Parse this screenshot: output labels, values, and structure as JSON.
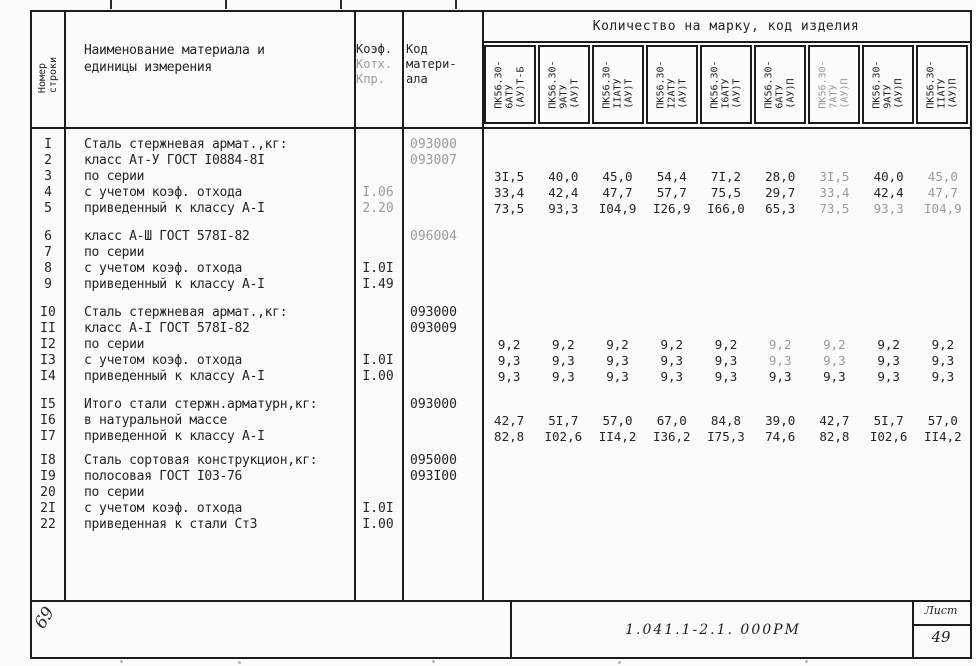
{
  "header": {
    "num_col_l1": "Номер",
    "num_col_l2": "строки",
    "material_l1": "Наименование материала и",
    "material_l2": "единицы измерения",
    "coef_l1": "Коэф.",
    "coef_l2": "Котх.",
    "coef_l3": "Кпр.",
    "code_l1": "Код",
    "code_l2": "матери-",
    "code_l3": "ала",
    "quantity_title": "Количество на марку, код изделия",
    "marks": [
      {
        "lines": [
          "ПК56.30-",
          "6АТУ",
          "(АУ)Т-Б"
        ],
        "faint": false
      },
      {
        "lines": [
          "ПК56.30-",
          "9АТУ",
          "(АУ)Т"
        ],
        "faint": false
      },
      {
        "lines": [
          "ПК56.30-",
          "IIАТУ",
          "(АУ)Т"
        ],
        "faint": false
      },
      {
        "lines": [
          "ПК56.30-",
          "I2АТУ",
          "(АУ)Т"
        ],
        "faint": false
      },
      {
        "lines": [
          "ПК56.30-",
          "I6АТУ",
          "(АУ)Т"
        ],
        "faint": false
      },
      {
        "lines": [
          "ПК56.30-",
          "6АТУ",
          "(АУ)П"
        ],
        "faint": false
      },
      {
        "lines": [
          "ПК56.30-",
          "7АТУ",
          "(АУ)П"
        ],
        "faint": true
      },
      {
        "lines": [
          "ПК56.30-",
          "9АТУ",
          "(АУ)П"
        ],
        "faint": false
      },
      {
        "lines": [
          "ПК56.30-",
          "IIАТУ",
          "(АУ)П"
        ],
        "faint": false
      }
    ]
  },
  "body": {
    "blocks": [
      {
        "rows": [
          {
            "num": "I",
            "name": "Сталь стержневая армат.,кг:",
            "coef": "",
            "code": "093000",
            "code_faint": true,
            "values": null,
            "faint_cols": []
          },
          {
            "num": "2",
            "name": "класс Ат-У ГОСТ I0884-8I",
            "coef": "",
            "code": "093007",
            "code_faint": true,
            "values": null,
            "faint_cols": []
          },
          {
            "num": "3",
            "name": "по серии",
            "coef": "",
            "code": "",
            "values": [
              "3I,5",
              "40,0",
              "45,0",
              "54,4",
              "7I,2",
              "28,0",
              "3I,5",
              "40,0",
              "45,0"
            ],
            "faint_cols": [
              6,
              8
            ]
          },
          {
            "num": "4",
            "name": "с учетом коэф. отхода",
            "coef": "I.06",
            "coef_faint": true,
            "code": "",
            "values": [
              "33,4",
              "42,4",
              "47,7",
              "57,7",
              "75,5",
              "29,7",
              "33,4",
              "42,4",
              "47,7"
            ],
            "faint_cols": [
              6,
              8
            ]
          },
          {
            "num": "5",
            "name": "приведенный к классу А-I",
            "coef": "2.20",
            "coef_faint": true,
            "code": "",
            "values": [
              "73,5",
              "93,3",
              "I04,9",
              "I26,9",
              "I66,0",
              "65,3",
              "73,5",
              "93,3",
              "I04,9"
            ],
            "faint_cols": [
              6,
              7,
              8
            ]
          }
        ]
      },
      {
        "rows": [
          {
            "num": "6",
            "name": "класс А-Ш ГОСТ 578I-82",
            "coef": "",
            "code": "096004",
            "code_faint": true,
            "values": null,
            "faint_cols": []
          },
          {
            "num": "7",
            "name": "по серии",
            "coef": "",
            "code": "",
            "values": null,
            "faint_cols": []
          },
          {
            "num": "8",
            "name": "с учетом коэф. отхода",
            "coef": "I.0I",
            "code": "",
            "values": null,
            "faint_cols": []
          },
          {
            "num": "9",
            "name": "приведенный к классу А-I",
            "coef": "I.49",
            "code": "",
            "values": null,
            "faint_cols": []
          }
        ]
      },
      {
        "rows": [
          {
            "num": "I0",
            "name": "Сталь стержневая армат.,кг:",
            "coef": "",
            "code": "093000",
            "values": null,
            "faint_cols": []
          },
          {
            "num": "II",
            "name": "класс А-I ГОСТ 578I-82",
            "coef": "",
            "code": "093009",
            "values": null,
            "faint_cols": []
          },
          {
            "num": "I2",
            "name": "по серии",
            "coef": "",
            "code": "",
            "values": [
              "9,2",
              "9,2",
              "9,2",
              "9,2",
              "9,2",
              "9,2",
              "9,2",
              "9,2",
              "9,2"
            ],
            "faint_cols": [
              5,
              6
            ]
          },
          {
            "num": "I3",
            "name": "с учетом коэф. отхода",
            "coef": "I.0I",
            "code": "",
            "values": [
              "9,3",
              "9,3",
              "9,3",
              "9,3",
              "9,3",
              "9,3",
              "9,3",
              "9,3",
              "9,3"
            ],
            "faint_cols": [
              5,
              6
            ]
          },
          {
            "num": "I4",
            "name": "приведенный к классу А-I",
            "coef": "I.00",
            "code": "",
            "values": [
              "9,3",
              "9,3",
              "9,3",
              "9,3",
              "9,3",
              "9,3",
              "9,3",
              "9,3",
              "9,3"
            ],
            "faint_cols": []
          }
        ]
      },
      {
        "rows": [
          {
            "num": "I5",
            "name": "Итого стали стержн.арматурн,кг:",
            "coef": "",
            "code": "093000",
            "values": null,
            "faint_cols": []
          },
          {
            "num": "I6",
            "name": "в натуральной массе",
            "coef": "",
            "code": "",
            "values": [
              "42,7",
              "5I,7",
              "57,0",
              "67,0",
              "84,8",
              "39,0",
              "42,7",
              "5I,7",
              "57,0"
            ],
            "faint_cols": []
          },
          {
            "num": "I7",
            "name": "приведенной к классу А-I",
            "coef": "",
            "code": "",
            "values": [
              "82,8",
              "I02,6",
              "II4,2",
              "I36,2",
              "I75,3",
              "74,6",
              "82,8",
              "I02,6",
              "II4,2"
            ],
            "faint_cols": []
          }
        ]
      },
      {
        "rows": [
          {
            "num": "I8",
            "name": "Сталь сортовая конструкцион,кг:",
            "coef": "",
            "code": "095000",
            "values": null,
            "faint_cols": []
          },
          {
            "num": "I9",
            "name": "полосовая ГОСТ I03-76",
            "coef": "",
            "code": "093I00",
            "values": null,
            "faint_cols": []
          },
          {
            "num": "20",
            "name": "по серии",
            "coef": "",
            "code": "",
            "values": null,
            "faint_cols": []
          },
          {
            "num": "2I",
            "name": "с учетом коэф. отхода",
            "coef": "I.0I",
            "code": "",
            "values": null,
            "faint_cols": []
          },
          {
            "num": "22",
            "name": "приведенная к стали Ст3",
            "coef": "I.00",
            "code": "",
            "values": null,
            "faint_cols": []
          }
        ]
      }
    ]
  },
  "footer": {
    "doc_number": "1.041.1-2.1. 000РМ",
    "sheet_label": "Лист",
    "sheet_number": "49",
    "handwritten_mark": "69"
  }
}
